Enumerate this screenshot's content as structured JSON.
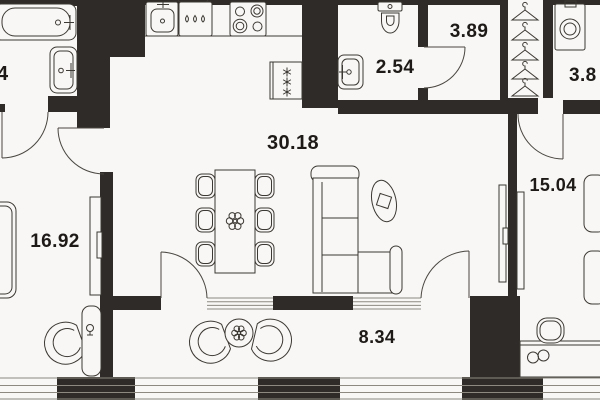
{
  "floor_plan": {
    "type": "apartment-floor-plan",
    "rooms": [
      {
        "name": "bathroom",
        "label": "4",
        "furniture": [
          "bathtub",
          "sink"
        ]
      },
      {
        "name": "wc",
        "label": "2.54",
        "furniture": [
          "toilet",
          "sink"
        ]
      },
      {
        "name": "hallway",
        "label": "3.89",
        "furniture": [
          "wardrobe-hangers"
        ]
      },
      {
        "name": "ensuite-bathroom",
        "label": "3.8",
        "furniture": [
          "washing-machine"
        ]
      },
      {
        "name": "kitchen-living-room",
        "label": "30.18",
        "furniture": [
          "kitchen-sink",
          "dishwasher",
          "stove",
          "fridge",
          "dining-table",
          "chairs",
          "sofa",
          "tv-console",
          "decor-oval"
        ]
      },
      {
        "name": "bedroom",
        "label": "16.92",
        "furniture": [
          "bed",
          "wardrobe",
          "armchair",
          "nightstand-lamp"
        ]
      },
      {
        "name": "bedroom-2",
        "label": "15.04",
        "furniture": [
          "bed",
          "tv-panel",
          "desk",
          "desk-chair",
          "glasses"
        ]
      },
      {
        "name": "balcony",
        "label": "8.34",
        "furniture": [
          "armchair",
          "armchair",
          "round-table-plant"
        ]
      }
    ],
    "colors": {
      "wall": "#2e2b28",
      "background": "#f8f7f5",
      "line": "#3c3833",
      "window": "#8d8981",
      "label": "#1d1a17"
    }
  }
}
